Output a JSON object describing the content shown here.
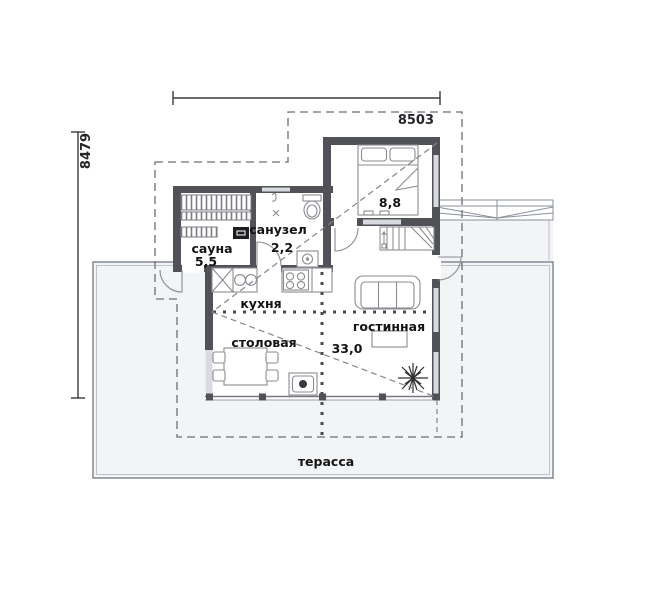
{
  "plan_title": "floor-plan",
  "dimensions": {
    "top": "8503",
    "left": "8479"
  },
  "rooms": {
    "sauna": {
      "label": "сауна",
      "area": "5,5"
    },
    "bathroom": {
      "label": "санузел",
      "area": "2,2"
    },
    "kitchen": {
      "label": "кухня"
    },
    "dining": {
      "label": "столовая"
    },
    "living": {
      "label": "гостинная",
      "area": "33,0"
    },
    "bedroom": {
      "area": "8,8"
    },
    "terrace": {
      "label": "терасса"
    }
  },
  "colors": {
    "wall": "#515258",
    "terrace_fill": "#f2f4f6",
    "roof_dash": "#6e6e74",
    "zone_dash": "#4a4a4e",
    "furniture_stroke": "#8b8b92",
    "text": "#141414"
  }
}
